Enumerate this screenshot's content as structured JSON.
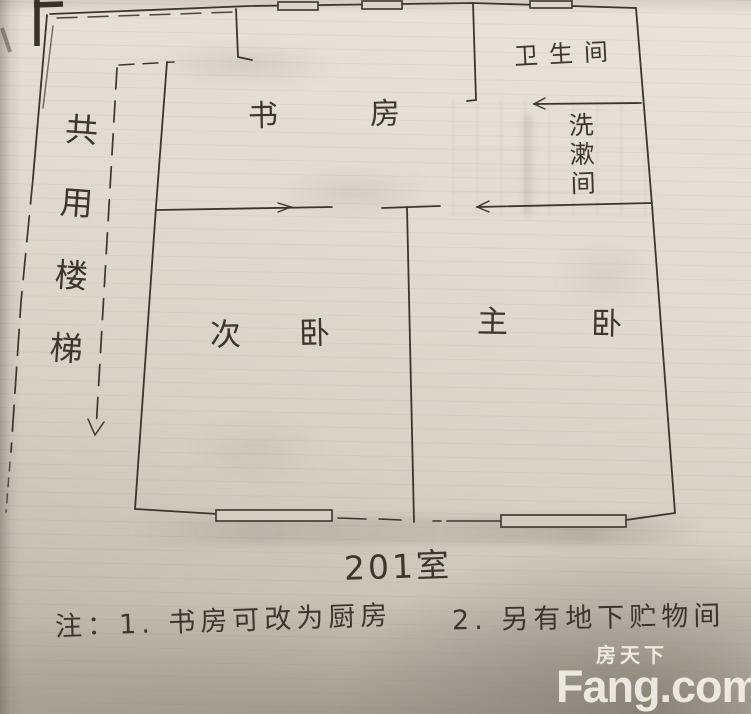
{
  "rooms": {
    "study": "书房",
    "bathroom": "卫生间",
    "washroom": "洗漱间",
    "secondary_bedroom": "次卧",
    "master_bedroom": "主卧",
    "shared_staircase": "共用楼梯"
  },
  "unit_label": "201室",
  "notes": {
    "line1": "注：1. 书房可改为厨房",
    "line2": "2. 另有地下贮物间"
  },
  "watermark": {
    "cn": "房天下",
    "en": "Fang.com"
  },
  "colors": {
    "paper": "#ded7c9",
    "ink": "#3b362d",
    "watermark_text": "#faf8f3"
  }
}
